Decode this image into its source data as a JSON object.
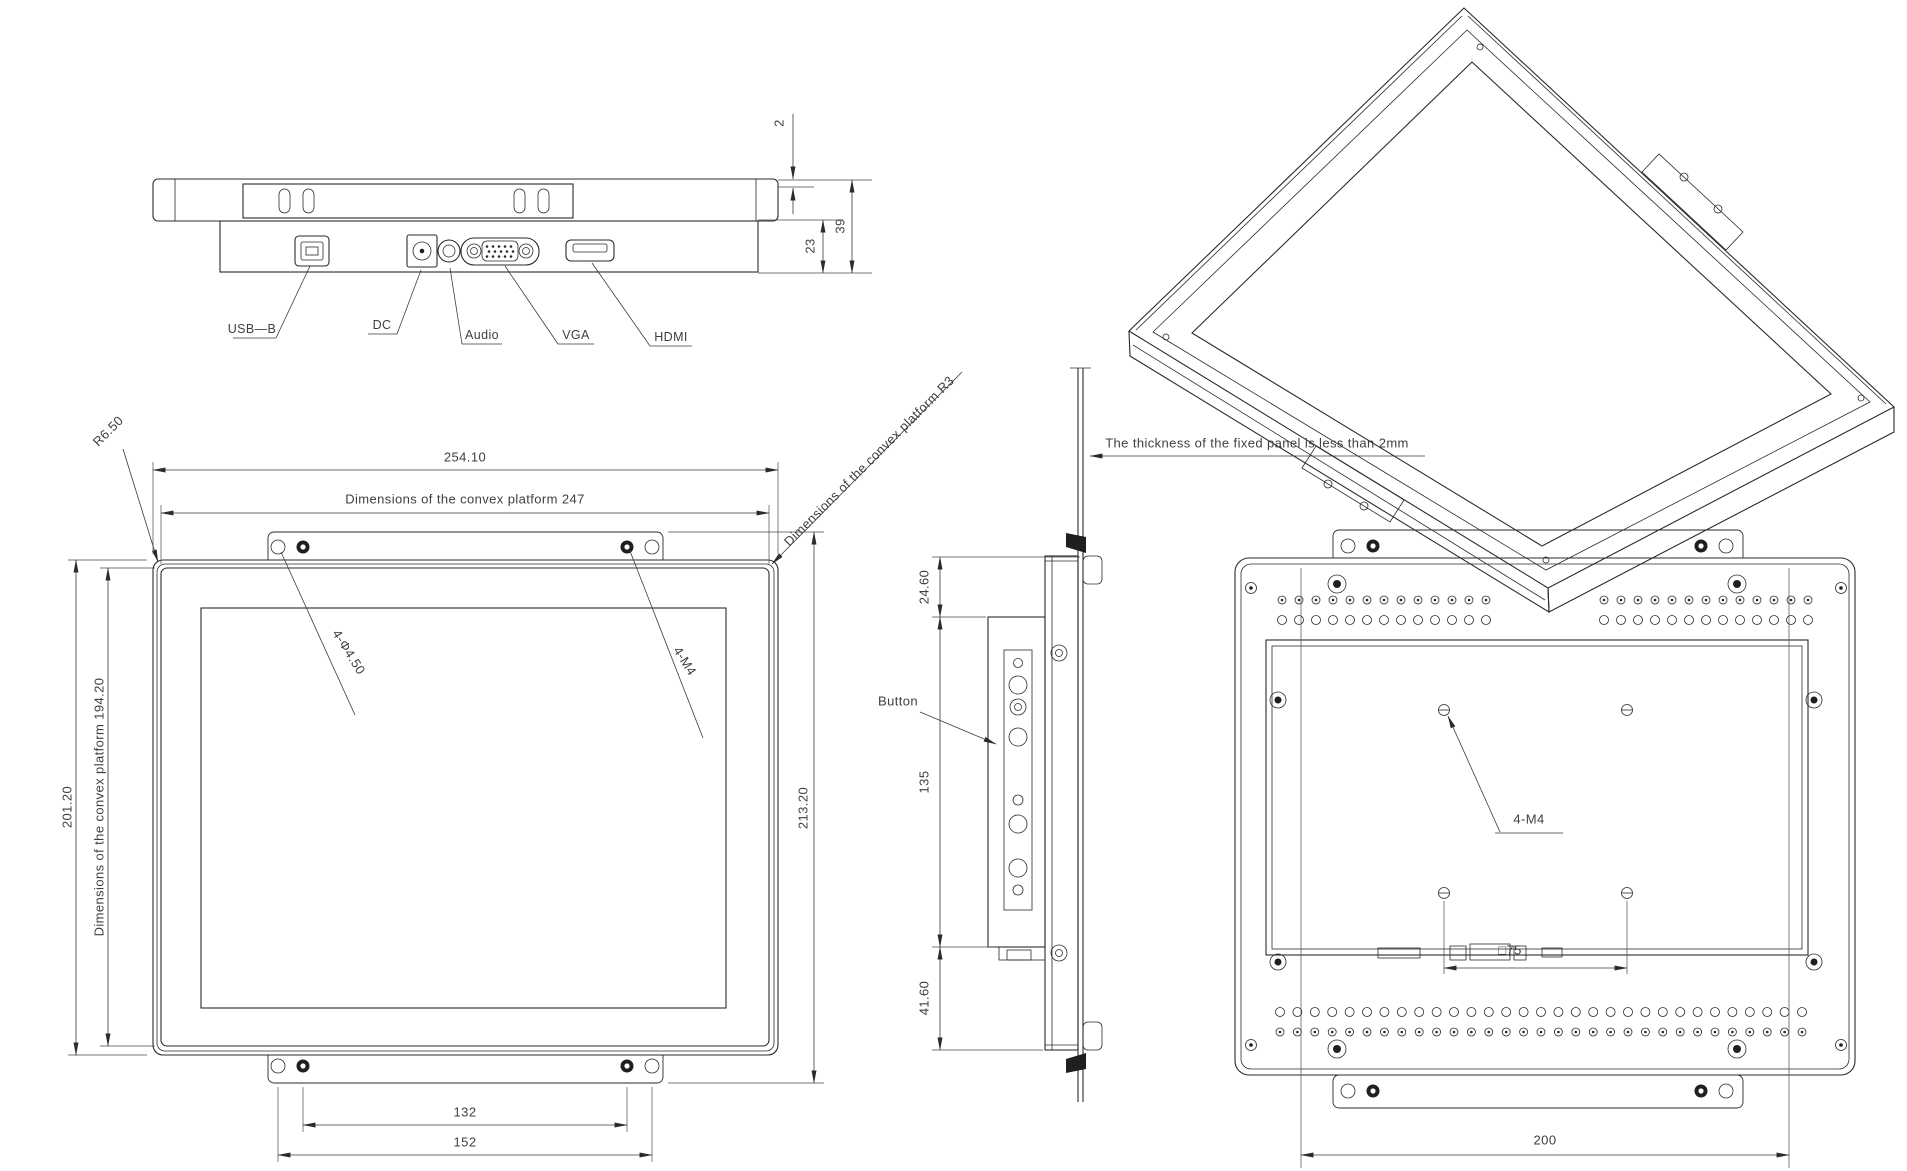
{
  "top_view": {
    "connector_labels": [
      "USB—B",
      "DC",
      "Audio",
      "VGA",
      "HDMI"
    ],
    "dimensions": {
      "bezel_lip": "2",
      "overall_depth": "39",
      "housing_depth": "23"
    }
  },
  "front_view": {
    "dimensions": {
      "overall_width": "254.10",
      "platform_width_note": "Dimensions of the convex platform 247",
      "overall_height": "201.20",
      "platform_height_note": "Dimensions of the convex platform 194.20",
      "mounting_height": "213.20",
      "inner_hole_span": "132",
      "outer_hole_span": "152",
      "corner_radius": "R6.50",
      "platform_radius_note": "Dimensions of the convex platform R3",
      "mount_hole_callout": "4-Φ4.50",
      "thread_hole_callout": "4-M4"
    }
  },
  "side_view": {
    "panel_note": "The thickness of the fixed panel is less than 2mm",
    "button_label": "Button",
    "dimensions": {
      "top_offset": "24.60",
      "button_board_height": "135",
      "bottom_offset": "41.60"
    }
  },
  "rear_view": {
    "dimensions": {
      "thread_hole_callout": "4-M4",
      "vesa_spacing": "□75",
      "mount_span": "200"
    }
  }
}
